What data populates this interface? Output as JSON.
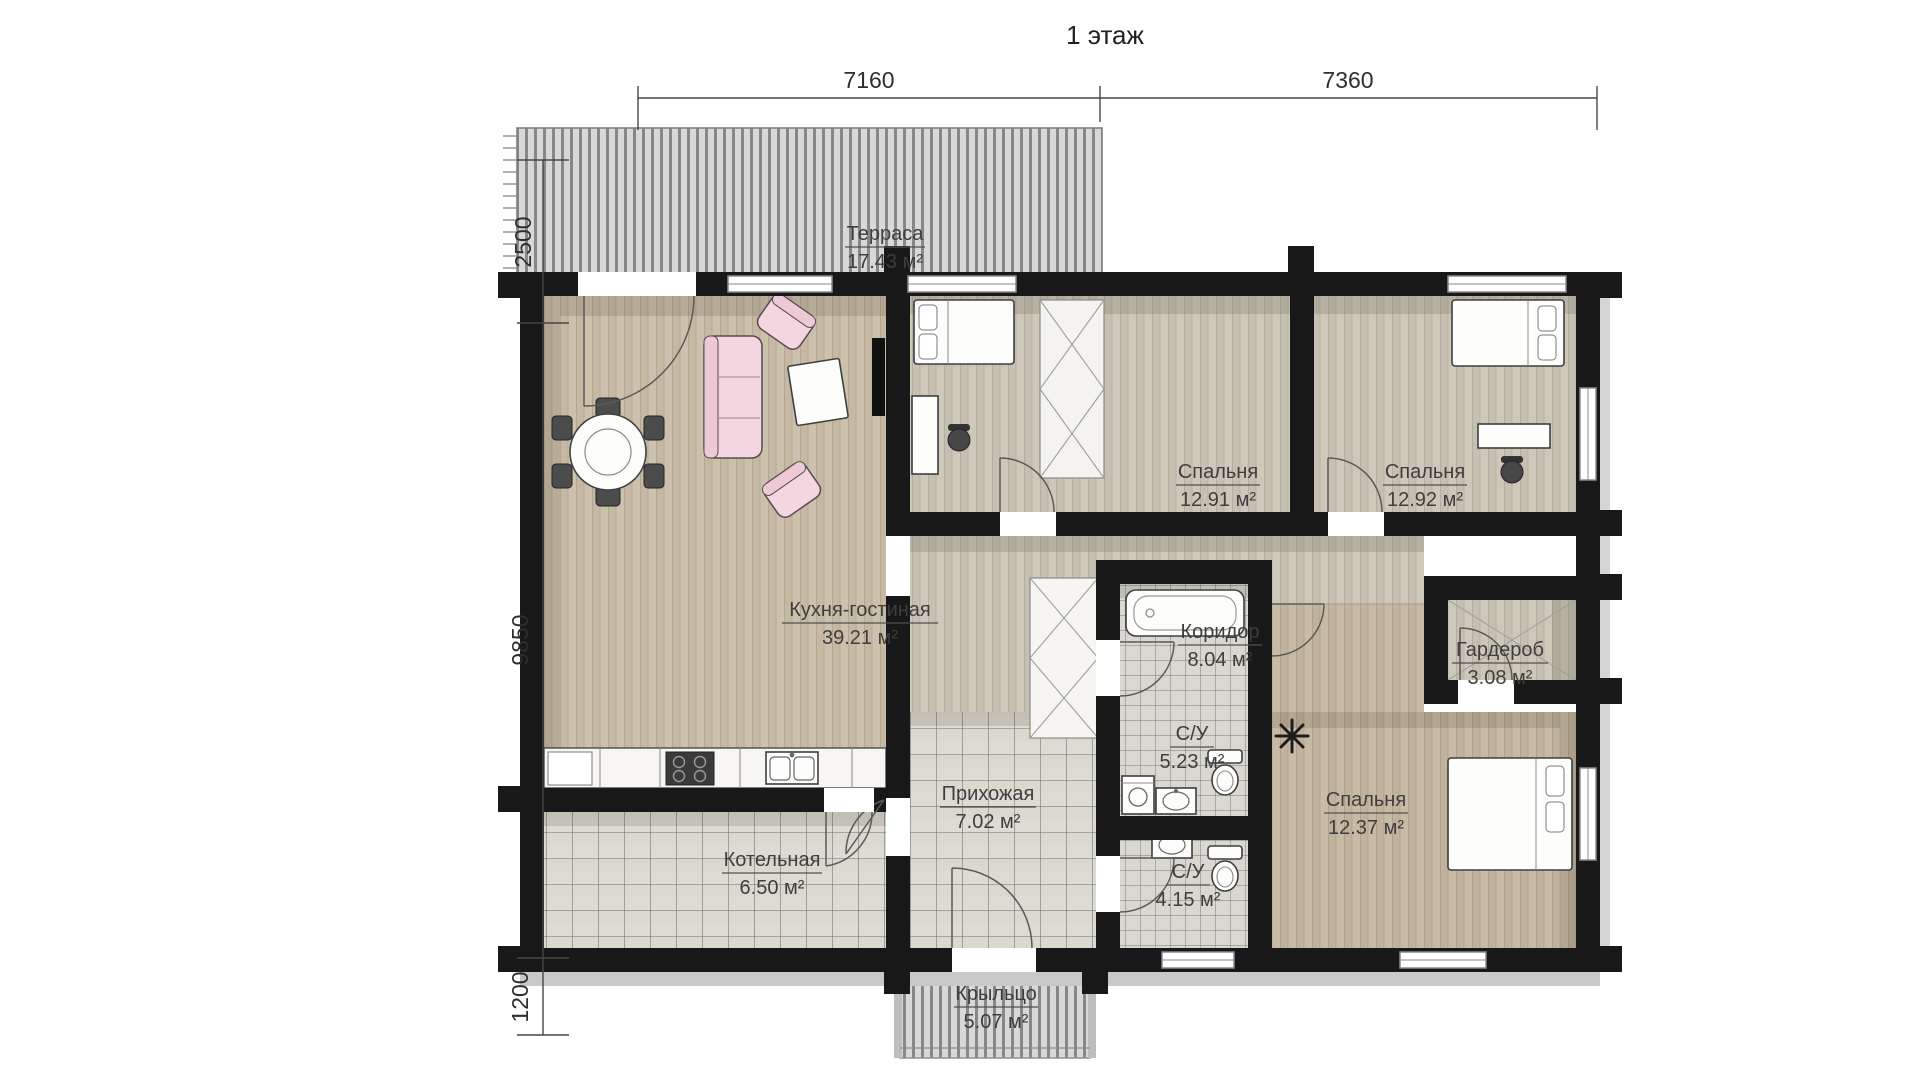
{
  "title": "1 этаж",
  "dimensions": {
    "top": [
      "7160",
      "7360"
    ],
    "left": [
      "2500",
      "9850",
      "1200"
    ]
  },
  "rooms": [
    {
      "name": "Терраса",
      "area": "17.43 м²"
    },
    {
      "name": "Кухня-гостиная",
      "area": "39.21 м²"
    },
    {
      "name": "Спальня",
      "area": "12.91 м²"
    },
    {
      "name": "Спальня",
      "area": "12.92 м²"
    },
    {
      "name": "Коридор",
      "area": "8.04 м²"
    },
    {
      "name": "Гардероб",
      "area": "3.08 м²"
    },
    {
      "name": "С/У",
      "area": "5.23 м²"
    },
    {
      "name": "С/У",
      "area": "4.15 м²"
    },
    {
      "name": "Прихожая",
      "area": "7.02 м²"
    },
    {
      "name": "Котельная",
      "area": "6.50 м²"
    },
    {
      "name": "Спальня",
      "area": "12.37 м²"
    },
    {
      "name": "Крыльцо",
      "area": "5.07 м²"
    }
  ],
  "colors": {
    "wall": "#181818",
    "wood_floor": "#cbc0ac",
    "tile_floor": "#dcdad2",
    "deck": "#d8d8d8",
    "accent_furniture": "#f3d6df",
    "label_text": "#3e3e3e"
  }
}
